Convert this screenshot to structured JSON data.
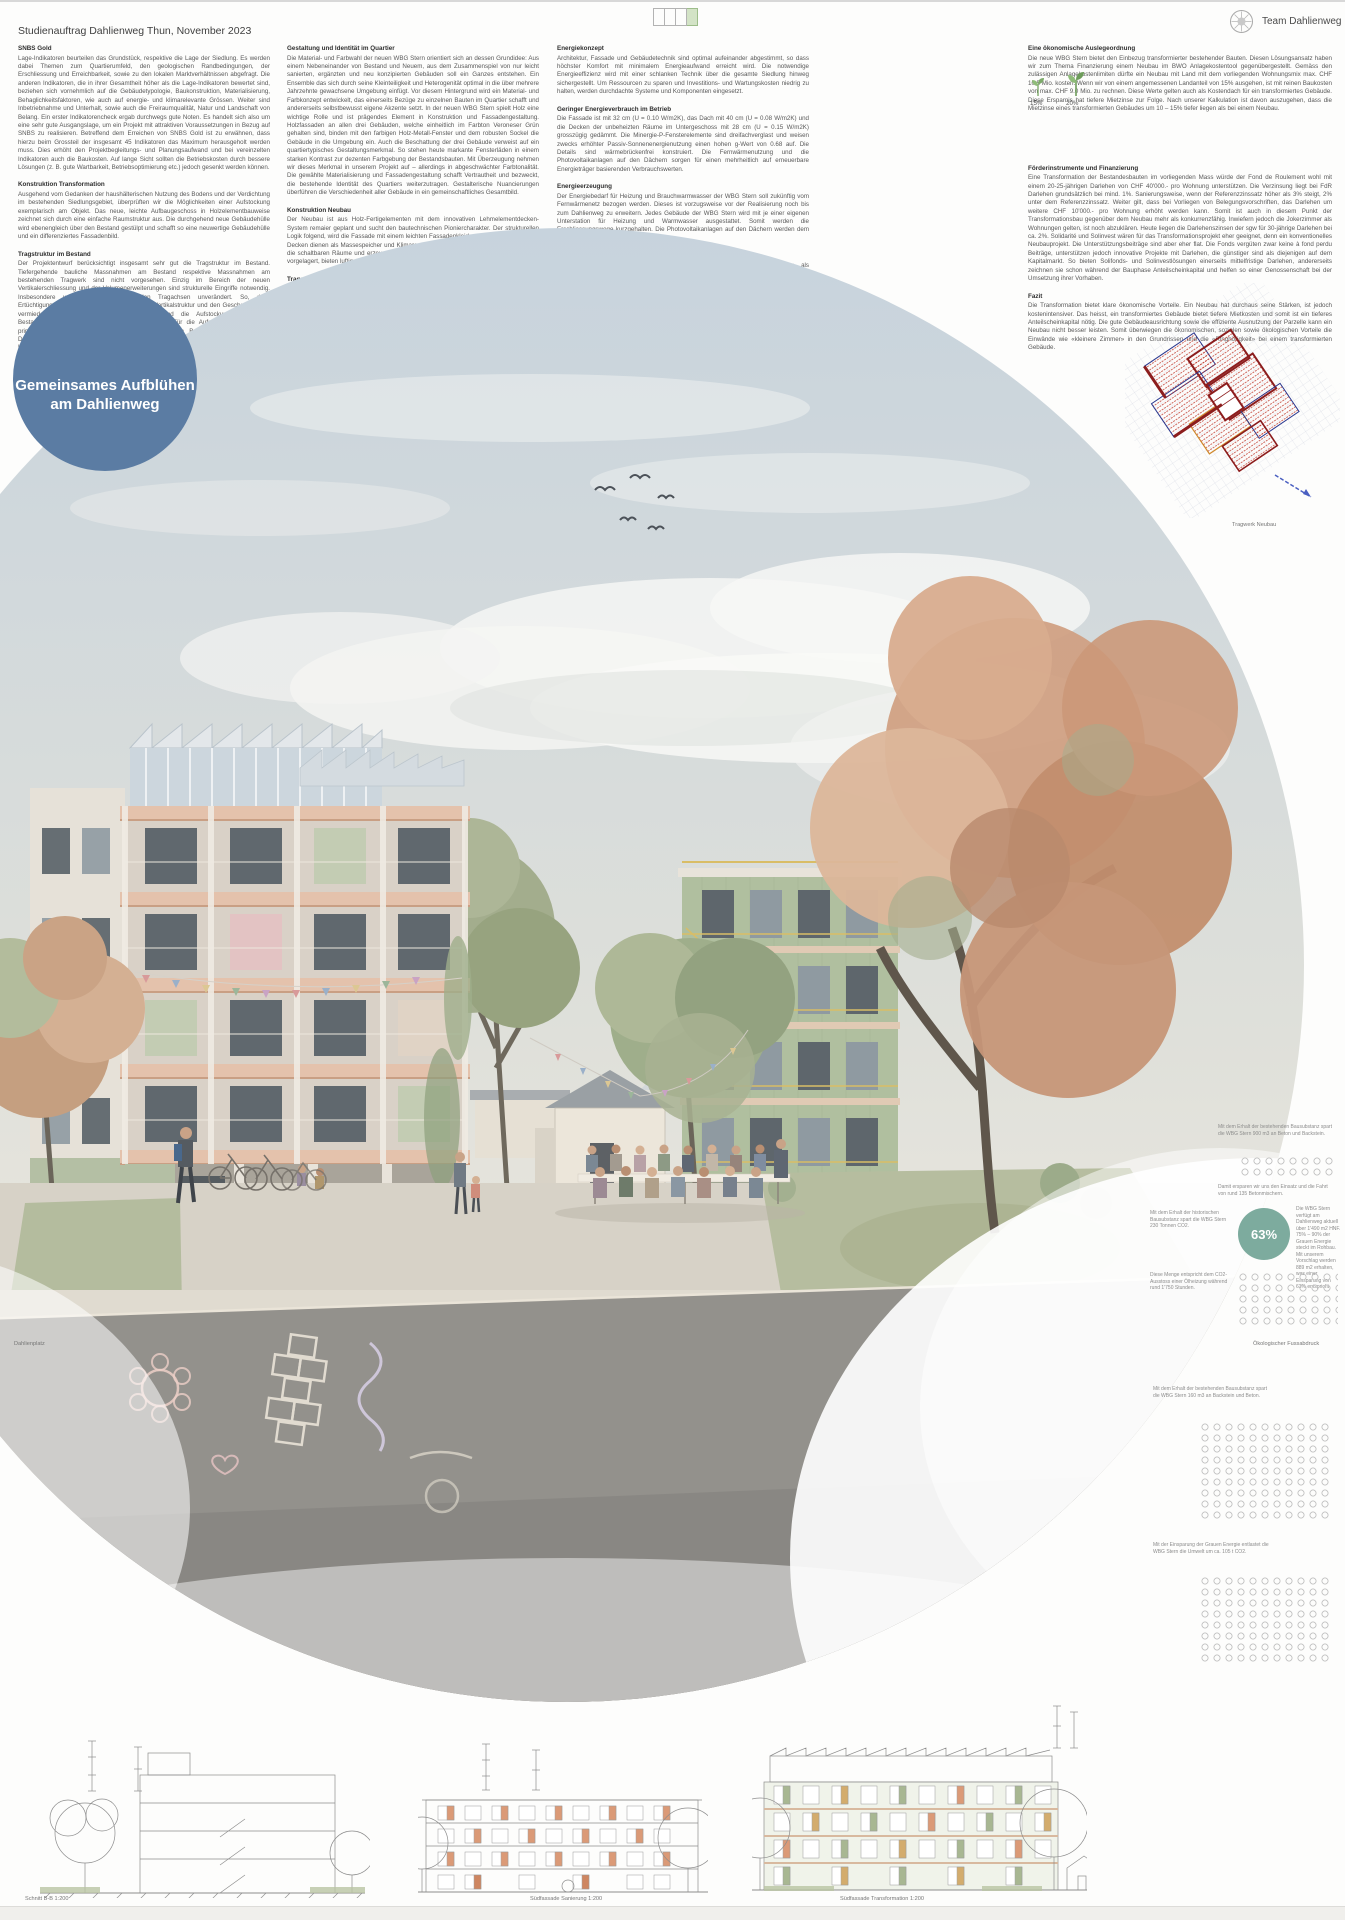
{
  "header": {
    "title": "Studienauftrag Dahlienweg Thun, November 2023",
    "team": "Team Dahlienweg"
  },
  "legend": {
    "total_boxes": 4,
    "filled_boxes": 1,
    "filled_color": "#d3e3c6"
  },
  "badge": {
    "line1": "Gemeinsames Aufblühen",
    "line2": "am Dahlienweg",
    "color": "#5b7ca3"
  },
  "columns": [
    {
      "sections": [
        {
          "heading": "SNBS Gold",
          "body": "Lage-Indikatoren beurteilen das Grundstück, respektive die Lage der Siedlung. Es werden dabei Themen zum Quartierumfeld, den geologischen Randbedingungen, der Erschliessung und Erreichbarkeit, sowie zu den lokalen Marktverhältnissen abgefragt. Die anderen Indikatoren, die in ihrer Gesamtheit höher als die Lage-Indikatoren bewertet sind, beziehen sich vornehmlich auf die Gebäudetypologie, Baukonstruktion, Materialisierung, Behaglichkeitsfaktoren, wie auch auf energie- und klimarelevante Grössen. Weiter sind Inbetriebnahme und Unterhalt, sowie auch die Freiraumqualität, Natur und Landschaft von Belang. Ein erster Indikatorencheck ergab durchwegs gute Noten. Es handelt sich also um eine sehr gute Ausgangslage, um ein Projekt mit attraktiven Voraussetzungen in Bezug auf SNBS zu realisieren. Betreffend dem Erreichen von SNBS Gold ist zu erwähnen, dass hierzu beim Grossteil der insgesamt 45 Indikatoren das Maximum herausgeholt werden muss. Dies erhöht den Projektbegleitungs- und Planungsaufwand und bei vereinzelten Indikatoren auch die Baukosten. Auf lange Sicht sollten die Betriebskosten durch bessere Lösungen (z. B. gute Wartbarkeit, Betriebsoptimierung etc.) jedoch gesenkt werden können."
        },
        {
          "heading": "Konstruktion Transformation",
          "body": "Ausgehend vom Gedanken der haushälterischen Nutzung des Bodens und der Verdichtung im bestehenden Siedlungsgebiet, überprüften wir die Möglichkeiten einer Aufstockung exemplarisch am Objekt. Das neue, leichte Aufbaugeschoss in Holzelementbauweise zeichnet sich durch eine einfache Raumstruktur aus. Die durchgehend neue Gebäudehülle wird ebenengleich über den Bestand gestülpt und schafft so eine neuwertige Gebäudehülle und ein differenziertes Fassadenbild."
        },
        {
          "heading": "Tragstruktur im Bestand",
          "body": "Der Projektentwurf berücksichtigt insgesamt sehr gut die Tragstruktur im Bestand. Tiefergehende bauliche Massnahmen am Bestand respektive Massnahmen am bestehenden Tragwerk sind nicht vorgesehen. Einzig im Bereich der neuen Vertikalerschliessung und der Volumenerweiterungen sind strukturelle Eingriffe notwendig. Insbesondere verbleiben die bestehenden Tragachsen unverändert. So, dass Ertüchtigungsmassnahmen an der bestehenden Vertikalstruktur und den Geschossdecken vermieden werden. Die Volumenerweiterung und die Aufstockungen bei den Bestandsbauten werden in Holzbauweise realisiert. Für die Aufstockung werden die primären vertikalen Tragachsen vom darunterliegenden Bestand übernommen. Die Deckenspannweiten und der durchgehende, auf den Bestand abgestimmte vertikale Lastabtrag entsprechen den Vorgaben des nachhaltigen Bauens. Im Bestand erfolgt die Aussteifung für Wind- und Erdbebeneinwirkung über die Scheibenwirkung der Geschossdecken und die vorhandenen, im Grundriss gut verteilten Wandscheiben. Die Grundsätze des ortsbezogenen Entwurfs sind eingehalten."
        }
      ]
    },
    {
      "sections": [
        {
          "heading": "Gestaltung und Identität im Quartier",
          "body": "Die Material- und Farbwahl der neuen WBG Stern orientiert sich an dessen Grundidee: Aus einem Nebeneinander von Bestand und Neuem, aus dem Zusammenspiel von nur leicht sanierten, ergänzten und neu konzipierten Gebäuden soll ein Ganzes entstehen. Ein Ensemble das sich durch seine Kleinteiligkeit und Heterogenität optimal in die über mehrere Jahrzehnte gewachsene Umgebung einfügt. Vor diesem Hintergrund wird ein Material- und Farbkonzept entwickelt, das einerseits Bezüge zu einzelnen Bauten im Quartier schafft und andererseits selbstbewusst eigene Akzente setzt. In der neuen WBG Stern spielt Holz eine wichtige Rolle und ist prägendes Element in Konstruktion und Fassadengestaltung. Holzfassaden an allen drei Gebäuden, welche einheitlich im Farbton Veroneser Grün gehalten sind, binden mit den farbigen Holz-Metall-Fenster und dem robusten Sockel die Gebäude in die Umgebung ein. Auch die Beschattung der drei Gebäude verweist auf ein quartiertypisches Gestaltungsmerkmal. So stehen heute markante Fensterläden in einem starken Kontrast zur dezenten Farbgebung der Bestandsbauten. Mit Überzeugung nehmen wir dieses Merkmal in unserem Projekt auf – allerdings in abgeschwächter Farbtonalität. Die gewählte Materialisierung und Fassadengestaltung schafft Vertrautheit und bezweckt, die bestehende Identität des Quartiers weiterzutragen. Gestalterische Nuancierungen überführen die Verschiedenheit aller Gebäude in ein gemeinschaftliches Gesamtbild."
        },
        {
          "heading": "Konstruktion Neubau",
          "body": "Der Neubau ist aus Holz-Fertigelementen mit dem innovativen Lehmelementdecken-System remaier geplant und sucht den bautechnischen Pioniercharakter. Der strukturellen Logik folgend, wird die Fassade mit einem leichten Fassadenkleid umwickelt. Die massiven Decken dienen als Massespeicher und Klimaregulatoren. Das robuste Holztragwerk stapelt die schaltbaren Räume und erzeugt ein dreidimensionales Raumcluster. Zum Gartenraum vorgelagert, bieten luftig, leichte Holzbalkone die privaten Pufferaussenräume."
        },
        {
          "heading": "Tragstruktur im Neubau",
          "body": "Das Tragwerk des Neubaus ist über alle Geschosse als Kombination von Holzrahmenbau und Holzskelettbau geplant. Einzig der Erschliessungskern ist in Massivbauweise vorgesehen. Im Gebäudeinnern erfolgt ein vertikaler Lastabtrag (mit Ausnahme der Kernwände in Beton) über Holzstützen und beidseits beplankte Holzständerwände. Mit der Beschränkung der Tragwände auf die Kern- und Wohnungstrennwände liegt der Fokus auf einer optimalen Nutzungsflexibilität der Grundrisse. Mit den vorgesehenen, über alle Geschosse konsequent durchlaufenden primären Tragachsen, ergeben sich für die Geschossdecken effiziente Spannweiten von max. 5.50 m. Die als Holz-Lehm-Decken angedachte Deckenkonstruktion hat eine hervorragende CO2-Bilanz, ist hochgradig rezyclierbar und ist wirtschaftlich kompetitiv zu herkömmlichen Systemen wie Rippen-, Holzkasten- oder Vollholzdecken. Die horizontale Stabilisierung für Wind- und Erdbebeneinwirkung wird durch die Scheibenwirkung der Geschossdecken, die beplankten Holzständerwände und die einzelnen Betonwände gewährleistet. Die Grundsätze des erdbebengerechten Entwurfs sind eingehalten."
        }
      ]
    },
    {
      "sections": [
        {
          "heading": "Energiekonzept",
          "body": "Architektur, Fassade und Gebäudetechnik sind optimal aufeinander abgestimmt, so dass höchster Komfort mit minimalem Energieaufwand erreicht wird. Die notwendige Energieeffizienz wird mit einer schlanken Technik über die gesamte Siedlung hinweg sichergestellt. Um Ressourcen zu sparen und Investitions- und Wartungskosten niedrig zu halten, werden durchdachte Systeme und Komponenten eingesetzt."
        },
        {
          "heading": "Geringer Energieverbrauch im Betrieb",
          "body": "Die Fassade ist mit 32 cm (U = 0.10 W/m2K), das Dach mit 40 cm (U = 0.08 W/m2K) und die Decken der unbeheizten Räume im Untergeschoss mit 28 cm (U = 0.15 W/m2K) grosszügig gedämmt. Die Minergie-P-Fensterelemente sind dreifachverglast und weisen zwecks erhöhter Passiv-Sonnenenergienutzung einen hohen g-Wert von 0.68 auf. Die Details sind wärmebrückenfrei konstruiert. Die Fernwärmenutzung und die Photovoltaikanlagen auf den Dächern sorgen für einen mehrheitlich auf erneuerbare Energieträger basierenden Verbrauchswerten."
        },
        {
          "heading": "Energieerzeugung",
          "body": "Der Energiebedarf für Heizung und Brauchwarmwasser der WBG Stern soll zukünftig vom Fernwärmenetz bezogen werden. Dieses ist vorzugsweise vor der Realisierung noch bis zum Dahlienweg zu erweitern. Jedes Gebäude der WBG Stern wird mit je einer eigenen Unterstation für Heizung und Warmwasser ausgestattet. Somit werden die Erschliessungswege kurzgehalten. Die Photovoltaikanlagen auf den Dächern werden dem heutigen Energiestandard gerecht."
        },
        {
          "heading": "Wärmeabgabe",
          "body": "In den transformierten und sanierten Gebäudestrukturen sind Radiatoren als Wärmeabgabesystem vorgesehen. Bestehende Unterlagsböden können somit beibehalten, Raumhöhen maximal gehalten und Erschliessungskosten einfach erneuert werden. Der Neubau wird punkto Flexibilität und Gestaltungsfreiheit mit einem Fussbodenheizungssystem ausgestattet."
        },
        {
          "heading": "Sanitär",
          "body": "Die einzelnen Nasszellen und Küchen werden über die platzsparenden Steigzonen mit den Medien versorgt. Das notwendige Warmwasser wird über Frischwasserstationen aufbereitet. Diese reduziert die Problematik von Legionellen und garantiert eine hygienische Warmwasseraufbereitung. Zudem werden die Warmwasserleitungen mittels Zirkulation bis zum Verteiler warmgehalten."
        }
      ]
    },
    {
      "sections": [
        {
          "heading": "Eine ökonomische Auslegeordnung",
          "body": "Die neue WBG Stern bietet den Einbezug transformierter bestehender Bauten. Diesen Lösungsansatz haben wir zum Thema Finanzierung einem Neubau im BWO Anlagekostentool gegenübergestellt. Gemäss den zulässigen Anlagekostenlimiten dürfte ein Neubau mit Land mit dem vorliegenden Wohnungsmix max. CHF 10.5 Mio. kosten. Wenn wir von einem angemessenen Landanteil von 15% ausgehen, ist mit reinen Baukosten von max. CHF 9.0 Mio. zu rechnen. Diese Werte gelten auch als Kostendach für ein transformiertes Gebäude. Diese Ersparnis hat tiefere Mietzinse zur Folge. Nach unserer Kalkulation ist davon auszugehen, dass die Mietzinse eines transformierten Gebäudes um 10 – 15% tiefer liegen als bei einem Neubau."
        },
        {
          "heading": "Förderinstrumente und Finanzierung",
          "body": "Eine Transformation der Bestandesbauten im vorliegenden Mass würde der Fond de Roulement wohl mit einem 20-25-jährigen Darlehen von CHF 40'000.- pro Wohnung unterstützen. Die Verzinsung liegt bei FdR Darlehen grundsätzlich bei mind. 1%. Sanierungsweise, wenn der Referenzzinssatz höher als 3% steigt, 2% unter dem Referenzzinssatz. Weiter gilt, dass bei Vorliegen von Belegungsvorschriften, das Darlehen um weitere CHF 10'000.- pro Wohnung erhöht werden kann. Somit ist auch in diesem Punkt der Transformationsbau gegenüber dem Neubau mehr als konkurrenzfähig. Inwiefern jedoch die Jokerzimmer als Wohnungen gelten, ist noch abzuklären. Heute liegen die Darlehenszinsen der sgw für 30-jährige Darlehen bei ca. 2%. Solidarité und Solinvest wären für das Transformationsprojekt eher geeignet, denn ein konventionelles Neubauprojekt. Die Unterstützungsbeiträge sind aber eher flat. Die Fonds vergüten zwar keine à fond perdu Beiträge, unterstützen jedoch innovative Projekte mit Darlehen, die günstiger sind als diejenigen auf dem Kapitalmarkt. So bieten Solifonds- und Solinvestlösungen einerseits mittelfristige Darlehen, andererseits zeichnen sie schon während der Bauphase Anteilscheinkapital und helfen so einer Genossenschaft bei der Umsetzung ihrer Vorhaben."
        },
        {
          "heading": "Fazit",
          "body": "Die Transformation bietet klare ökonomische Vorteile. Ein Neubau hat durchaus seine Stärken, ist jedoch kostenintensiver. Das heisst, ein transformiertes Gebäude bietet tiefere Mietkosten und somit ist ein tieferes Anteilscheinkapital nötig. Die gute Gebäudeausrichtung sowie die effiziente Ausnutzung der Parzelle kann ein Neubau nicht besser leisten. Somit überwiegen die ökonomischen, sozialen sowie ökologischen Vorteile die Einwände wie «kleinere Zimmer» in den Grundrissen und die «Ringhörigkeit» bei einem transformierten Gebäude."
        }
      ]
    }
  ],
  "economy_icons": {
    "labels": [
      "15%",
      "20%"
    ]
  },
  "plan": {
    "caption": "Tragwerk Neubau"
  },
  "scene": {
    "caption_left": "Dahlienplatz"
  },
  "eco": {
    "caption": "Ökologischer Fussabdruck",
    "stat": "63%",
    "blocks": {
      "a": "Mit dem Erhalt der bestehenden Bausubstanz spart die WBG Stern 900 m3 an Beton und Backstein.",
      "a2": "Damit ersparen wir uns den Einsatz und die Fahrt von rund 135 Betonmischern.",
      "b_left": "Mit dem Erhalt der historischen Bausubstanz spart die WBG Stern 230 Tonnen CO2.",
      "b_right": "Die WBG Stern verfügt am Dahlienweg aktuell über 1'490 m2 HNF. 75% – 90% der Grauen Energie steckt im Rohbau. Mit unserem Vorschlag werden 889 m2 erhalten, was einer Einsparung von 63% entspricht.",
      "c": "Diese Menge entspricht dem CO2-Ausstoss einer Ölheizung während rund 1'750 Stunden.",
      "d": "Mit dem Erhalt der bestehenden Bausubstanz spart die WBG Stern 160 m3 an Backstein und Beton.",
      "e": "Mit der Einsparung der Grauen Energie entlastet die WBG Stern die Umwelt um ca. 105 t CO2."
    }
  },
  "drawings": {
    "captions": [
      "Schnitt B-B 1:200",
      "Südfassade Sanierung 1:200",
      "Südfassade Transformation 1:200"
    ]
  }
}
